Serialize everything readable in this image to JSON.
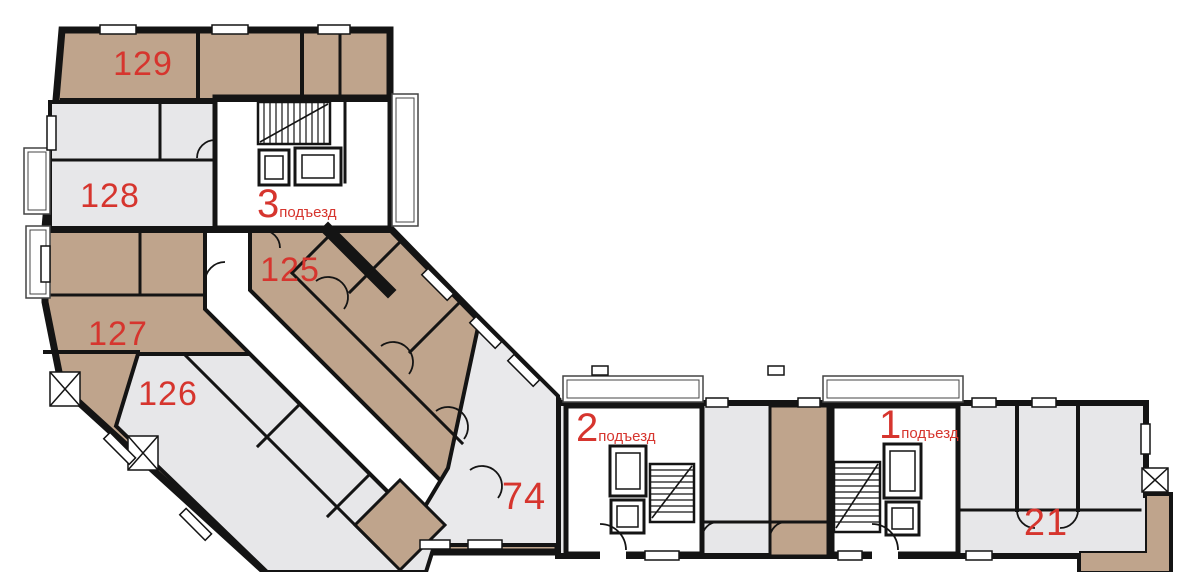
{
  "floorplan": {
    "title": "apartment-building-floor-plan",
    "apartments": [
      {
        "number": "129"
      },
      {
        "number": "128"
      },
      {
        "number": "125"
      },
      {
        "number": "127"
      },
      {
        "number": "126"
      },
      {
        "number": "74"
      },
      {
        "number": "21"
      }
    ],
    "entrances": [
      {
        "number": "3",
        "word": "подъезд"
      },
      {
        "number": "2",
        "word": "подъезд"
      },
      {
        "number": "1",
        "word": "подъезд"
      }
    ],
    "colors": {
      "walls": "#141414",
      "room_tan": "#bfa48c",
      "room_gray": "#e7e7e9",
      "label_red": "#d6352e",
      "background": "#ffffff"
    }
  }
}
